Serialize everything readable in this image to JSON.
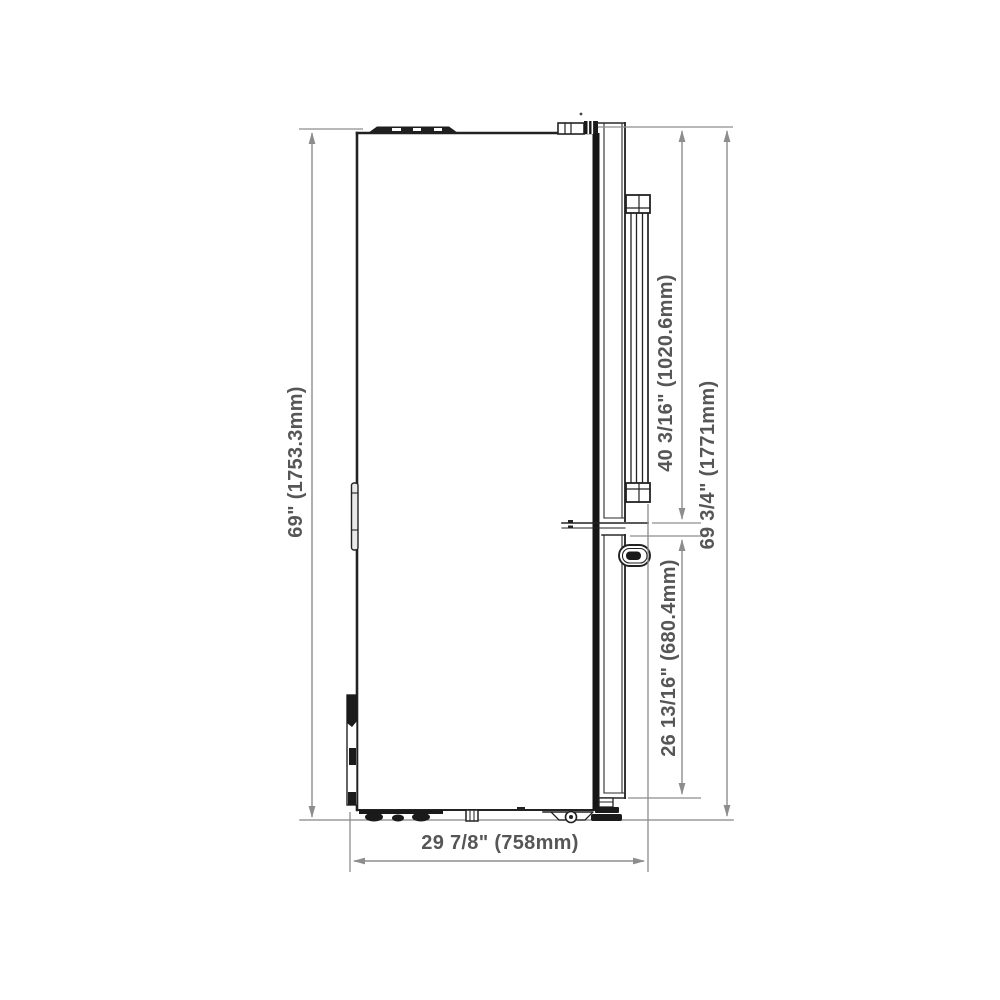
{
  "diagram": {
    "subject": "Refrigerator side-view dimension drawing",
    "labels": {
      "overall_height": "69\" (1753.3mm)",
      "upper_door_height": "40 3/16\" (1020.6mm)",
      "total_height": "69 3/4\" (1771mm)",
      "lower_door_height": "26 13/16\" (680.4mm)",
      "depth": "29 7/8\" (758mm)"
    },
    "colors": {
      "outline": "#1c1c1c",
      "dimension_line": "#8d8d8d",
      "ground_line": "#9a9a9a",
      "label_text": "#565656",
      "background": "#ffffff"
    }
  }
}
